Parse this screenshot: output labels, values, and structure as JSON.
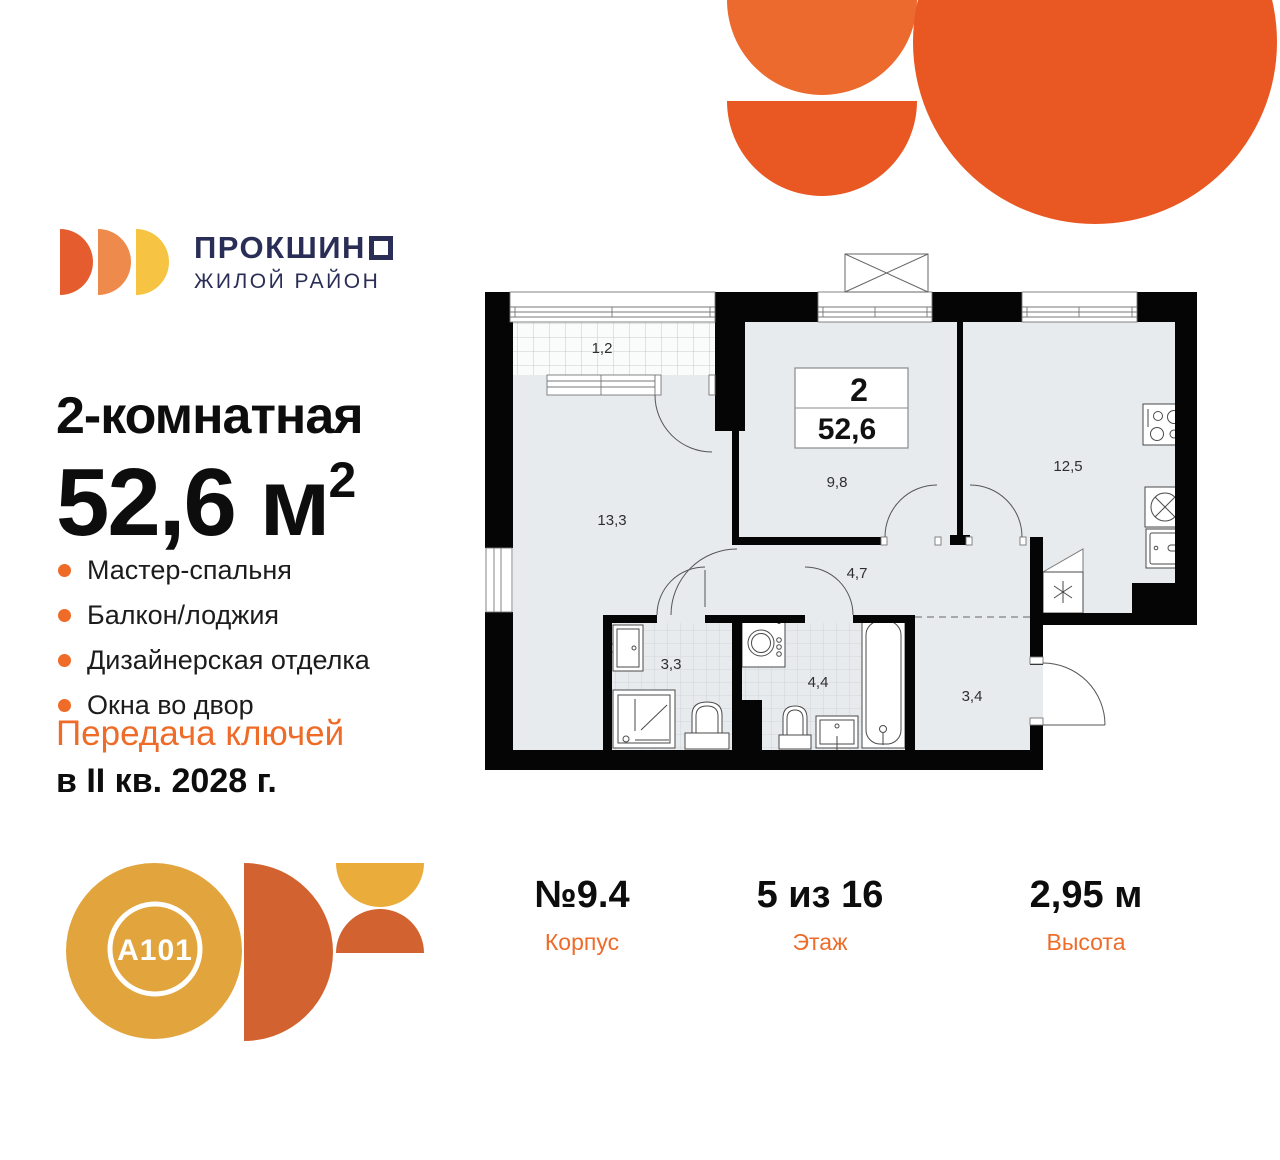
{
  "brand": {
    "name_prefix": "ПРОКШИН",
    "tagline": "ЖИЛОЙ РАЙОН"
  },
  "listing": {
    "rooms_title": "2-комнатная",
    "area_value": "52,6",
    "area_unit": " м",
    "area_sup": "2",
    "features": [
      "Мастер-спальня",
      "Балкон/лоджия",
      "Дизайнерская отделка",
      "Окна во двор"
    ],
    "handover_line1": "Передача ключей",
    "handover_line2": "в II кв. 2028 г."
  },
  "developer": {
    "logo_text": "A101"
  },
  "plan": {
    "badge": {
      "rooms": "2",
      "area": "52,6"
    },
    "rooms": {
      "balcony": "1,2",
      "master_bedroom": "13,3",
      "bedroom": "9,8",
      "kitchen": "12,5",
      "corridor": "4,7",
      "bathroom": "3,3",
      "bathroom2": "4,4",
      "hallway": "3,4"
    }
  },
  "details": [
    {
      "value": "№9.4",
      "label": "Корпус"
    },
    {
      "value": "5 из 16",
      "label": "Этаж"
    },
    {
      "value": "2,95 м",
      "label": "Высота"
    }
  ],
  "colors": {
    "accent": "#EE6B28",
    "navy": "#2A2E56",
    "deco_light": "#EC6A2E",
    "deco_dark": "#E95722",
    "floor": "#E8EBEE"
  }
}
